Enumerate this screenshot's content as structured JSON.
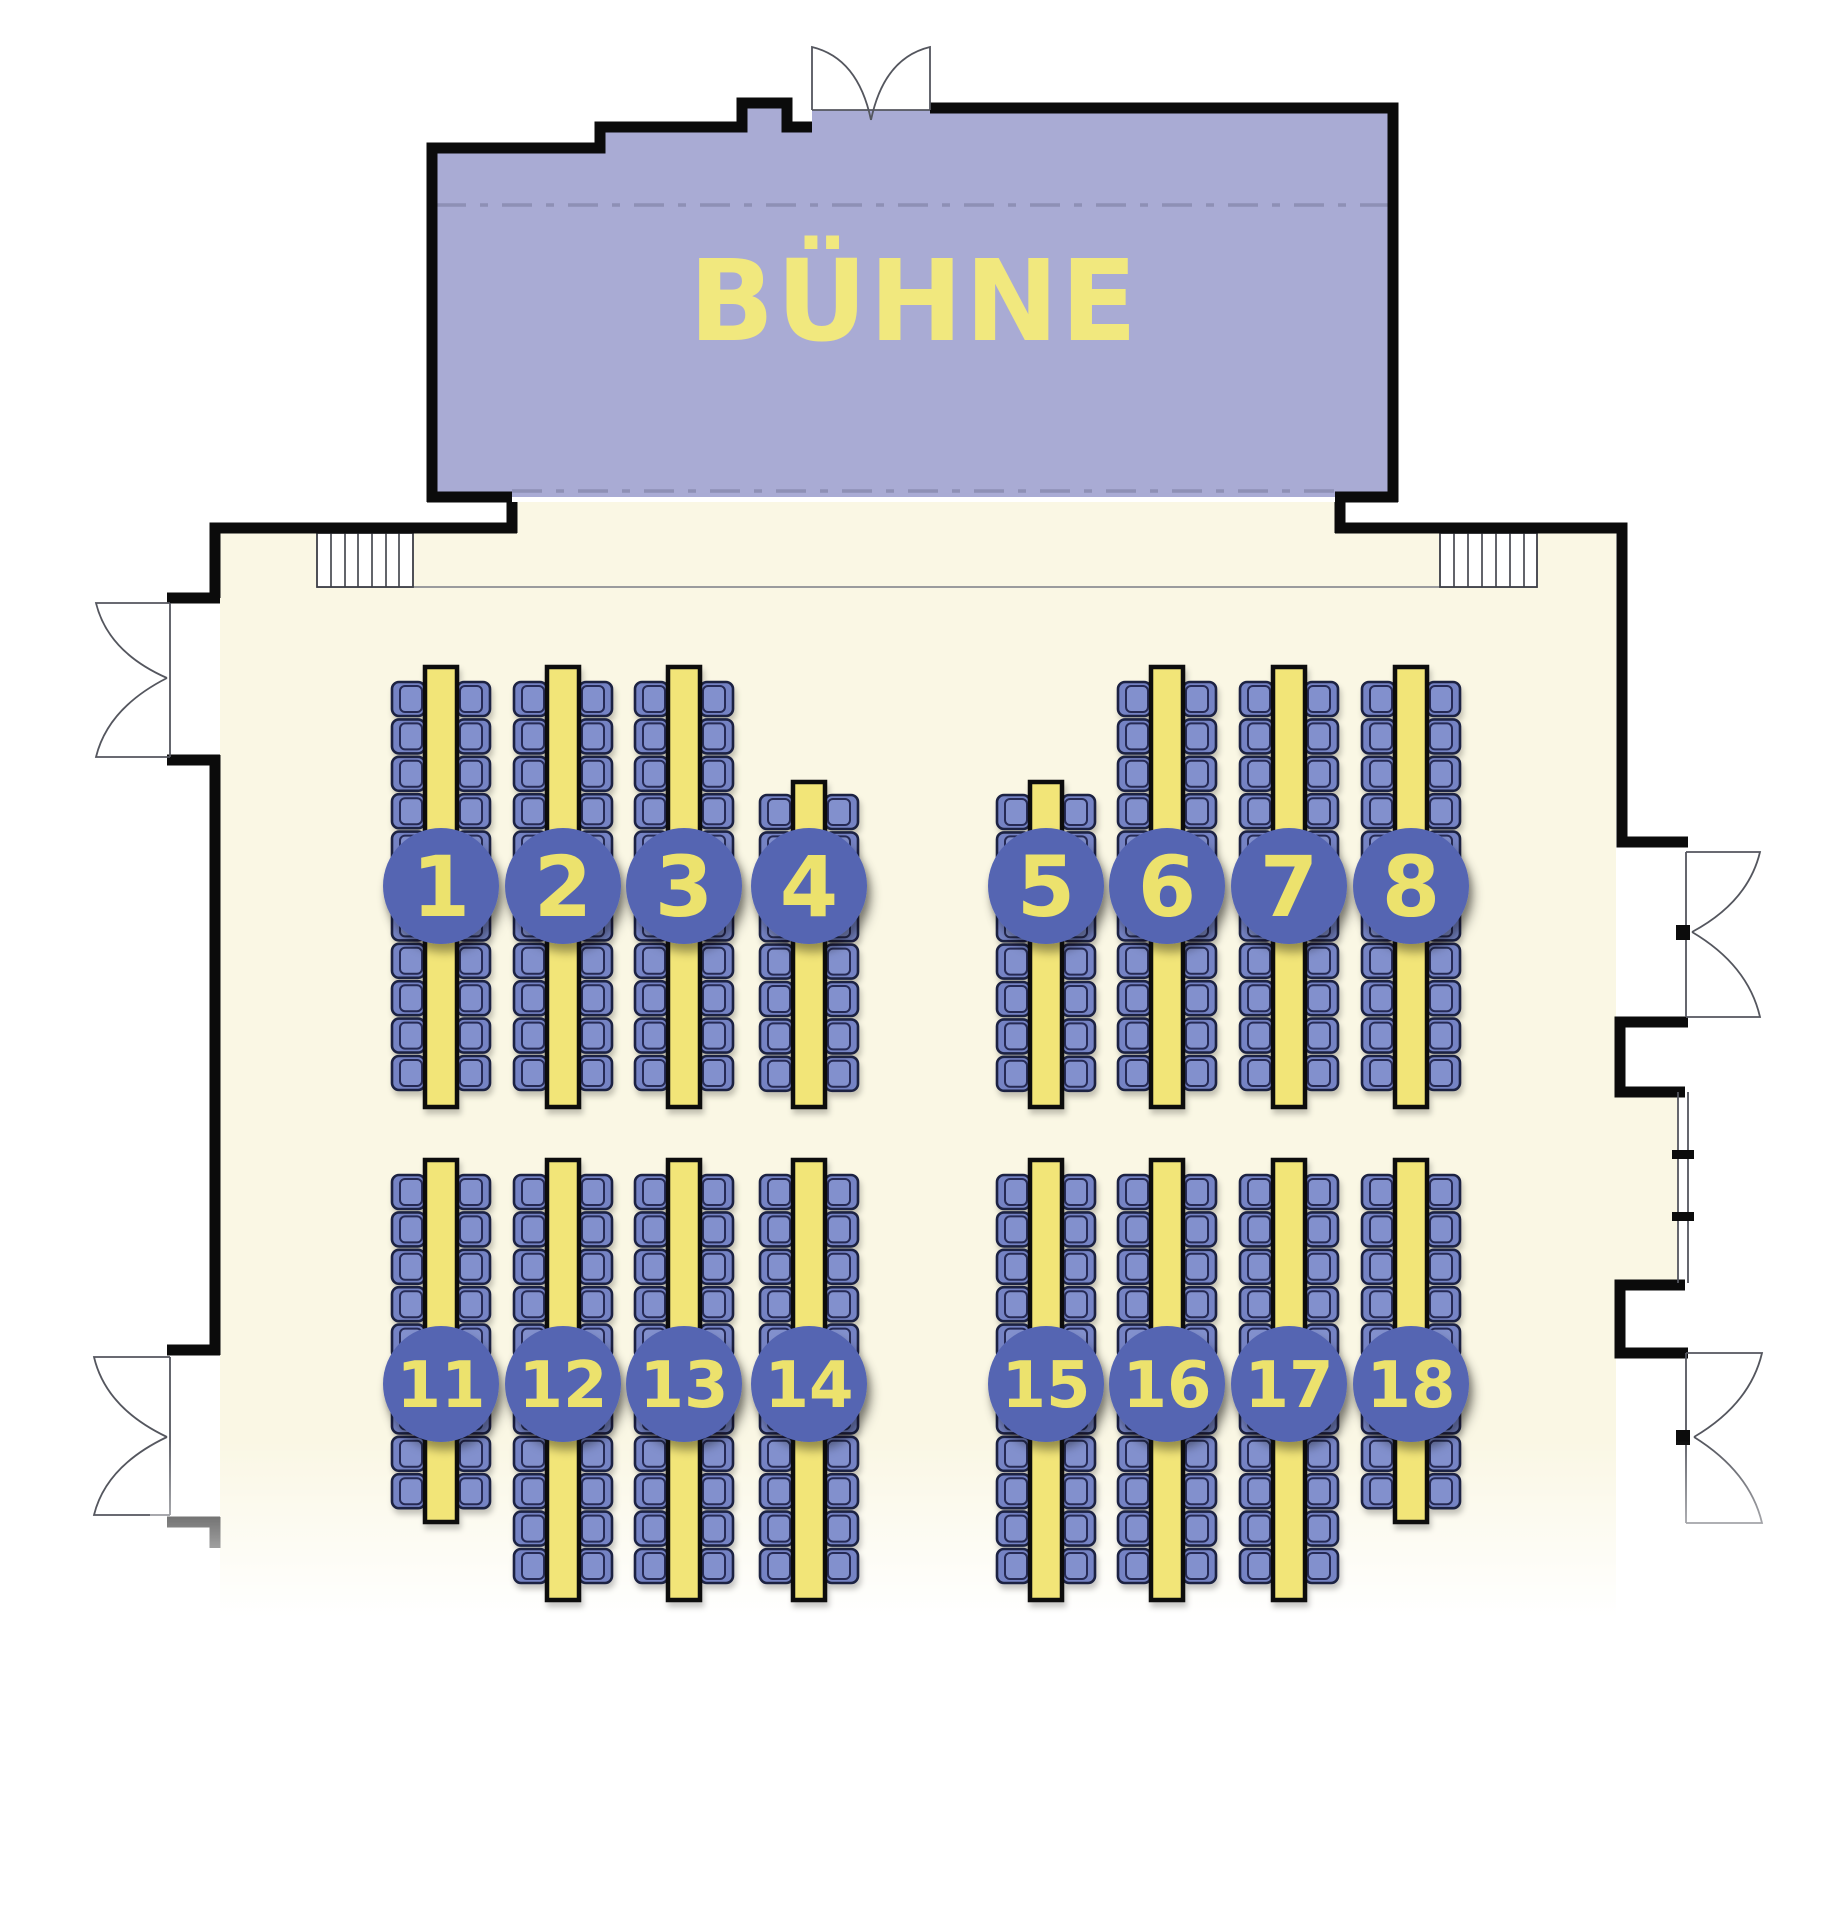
{
  "stage": {
    "label": "BÜHNE"
  },
  "colors": {
    "stage_fill": "#a9abd4",
    "stage_text": "#f1e87e",
    "floor": "#faf7e4",
    "outside": "#ffffff",
    "wall": "#0b0b0b",
    "table_fill": "#f2e578",
    "chair_fill": "#7583c4",
    "chair_stroke": "#1c2142",
    "chair_inner": "#8290cd",
    "badge_fill": "#5565b2",
    "badge_text": "#ece26d",
    "dash_line": "#8e90b5"
  },
  "fixtures": [
    "stairs-left",
    "stairs-right",
    "double-door-stage-top",
    "double-door-left-upper",
    "double-door-left-lower",
    "double-door-right-upper",
    "double-door-right-lower",
    "window-right",
    "walkway-line"
  ],
  "tables": [
    {
      "number": "1",
      "cx": 441,
      "strip_top": 667,
      "strip_bottom": 1107,
      "chairs_top": 682,
      "chairs_per_side": 11,
      "badge_cy": 886
    },
    {
      "number": "2",
      "cx": 563,
      "strip_top": 667,
      "strip_bottom": 1107,
      "chairs_top": 682,
      "chairs_per_side": 11,
      "badge_cy": 886
    },
    {
      "number": "3",
      "cx": 684,
      "strip_top": 667,
      "strip_bottom": 1107,
      "chairs_top": 682,
      "chairs_per_side": 11,
      "badge_cy": 886
    },
    {
      "number": "4",
      "cx": 809,
      "strip_top": 782,
      "strip_bottom": 1107,
      "chairs_top": 795,
      "chairs_per_side": 8,
      "badge_cy": 886
    },
    {
      "number": "5",
      "cx": 1046,
      "strip_top": 782,
      "strip_bottom": 1107,
      "chairs_top": 795,
      "chairs_per_side": 8,
      "badge_cy": 886
    },
    {
      "number": "6",
      "cx": 1167,
      "strip_top": 667,
      "strip_bottom": 1107,
      "chairs_top": 682,
      "chairs_per_side": 11,
      "badge_cy": 886
    },
    {
      "number": "7",
      "cx": 1289,
      "strip_top": 667,
      "strip_bottom": 1107,
      "chairs_top": 682,
      "chairs_per_side": 11,
      "badge_cy": 886
    },
    {
      "number": "8",
      "cx": 1411,
      "strip_top": 667,
      "strip_bottom": 1107,
      "chairs_top": 682,
      "chairs_per_side": 11,
      "badge_cy": 886
    },
    {
      "number": "11",
      "cx": 441,
      "strip_top": 1160,
      "strip_bottom": 1522,
      "chairs_top": 1175,
      "chairs_per_side": 9,
      "badge_cy": 1384
    },
    {
      "number": "12",
      "cx": 563,
      "strip_top": 1160,
      "strip_bottom": 1600,
      "chairs_top": 1175,
      "chairs_per_side": 11,
      "badge_cy": 1384
    },
    {
      "number": "13",
      "cx": 684,
      "strip_top": 1160,
      "strip_bottom": 1600,
      "chairs_top": 1175,
      "chairs_per_side": 11,
      "badge_cy": 1384
    },
    {
      "number": "14",
      "cx": 809,
      "strip_top": 1160,
      "strip_bottom": 1600,
      "chairs_top": 1175,
      "chairs_per_side": 11,
      "badge_cy": 1384
    },
    {
      "number": "15",
      "cx": 1046,
      "strip_top": 1160,
      "strip_bottom": 1600,
      "chairs_top": 1175,
      "chairs_per_side": 11,
      "badge_cy": 1384
    },
    {
      "number": "16",
      "cx": 1167,
      "strip_top": 1160,
      "strip_bottom": 1600,
      "chairs_top": 1175,
      "chairs_per_side": 11,
      "badge_cy": 1384
    },
    {
      "number": "17",
      "cx": 1289,
      "strip_top": 1160,
      "strip_bottom": 1600,
      "chairs_top": 1175,
      "chairs_per_side": 11,
      "badge_cy": 1384
    },
    {
      "number": "18",
      "cx": 1411,
      "strip_top": 1160,
      "strip_bottom": 1522,
      "chairs_top": 1175,
      "chairs_per_side": 9,
      "badge_cy": 1384
    }
  ]
}
